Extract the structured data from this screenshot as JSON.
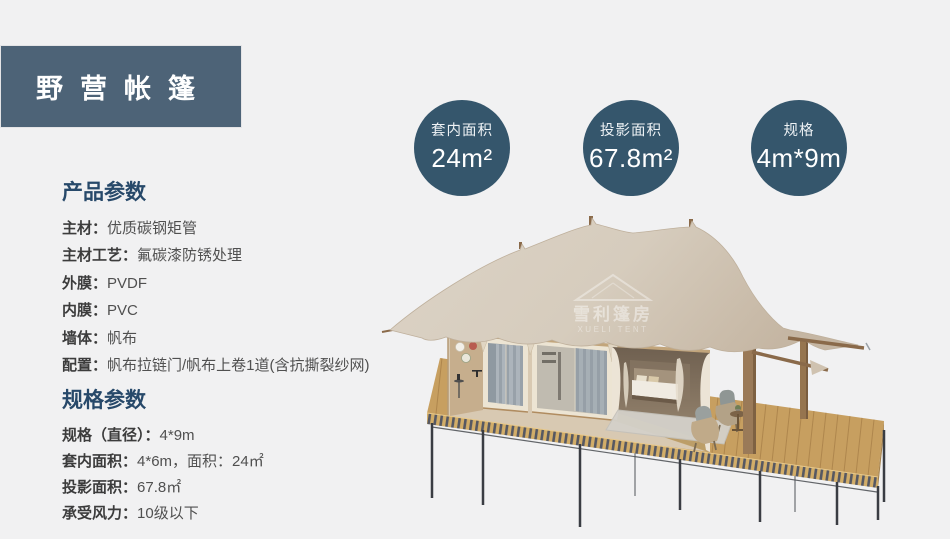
{
  "page": {
    "background": "#f1f1f2"
  },
  "header": {
    "title": "野营帐篷"
  },
  "stats": [
    {
      "label": "套内面积",
      "value": "24m²"
    },
    {
      "label": "投影面积",
      "value": "67.8m²"
    },
    {
      "label": "规格",
      "value": "4m*9m"
    }
  ],
  "product_params": {
    "heading": "产品参数",
    "rows": [
      {
        "label": "主材：",
        "value": "优质碳钢矩管"
      },
      {
        "label": "主材工艺：",
        "value": "氟碳漆防锈处理"
      },
      {
        "label": "外膜：",
        "value": "PVDF"
      },
      {
        "label": "内膜：",
        "value": "PVC"
      },
      {
        "label": "墙体：",
        "value": "帆布"
      },
      {
        "label": "配置：",
        "value": "帆布拉链门/帆布上卷1道(含抗撕裂纱网)"
      }
    ]
  },
  "spec_params": {
    "heading": "规格参数",
    "rows": [
      {
        "label": "规格（直径）：",
        "value": "4*9m"
      },
      {
        "label": "套内面积：",
        "value": "4*6m，面积：24㎡"
      },
      {
        "label": "投影面积：",
        "value": "67.8㎡"
      },
      {
        "label": "承受风力：",
        "value": "10级以下"
      }
    ]
  },
  "tent_image": {
    "watermark_cn": "雪利篷房",
    "watermark_en": "XUELI TENT"
  },
  "colors": {
    "header_bg": "#4d6377",
    "circle_bg": "#35566c",
    "heading_text": "#27496a",
    "roof_canvas": "#d5cbbc",
    "deck_wood": "#c79f60"
  }
}
